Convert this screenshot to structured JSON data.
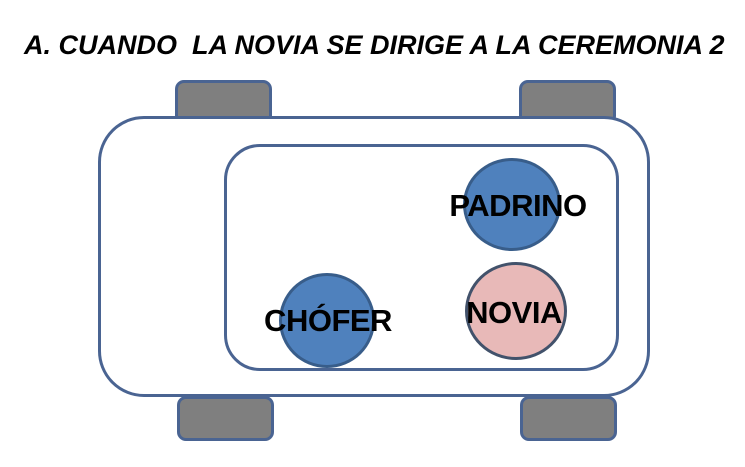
{
  "title": "A. CUANDO  LA NOVIA SE DIRIGE A LA CEREMONIA 2",
  "diagram": {
    "type": "car-seating-top-view",
    "seats": [
      {
        "id": "padrino",
        "label": "PADRINO",
        "position": "back-row-right",
        "fill": "#4f81bd",
        "border": "#385d8a"
      },
      {
        "id": "chofer",
        "label": "CHÓFER",
        "position": "front-row-left",
        "fill": "#4f81bd",
        "border": "#385d8a"
      },
      {
        "id": "novia",
        "label": "NOVIA",
        "position": "front-row-right",
        "fill": "#e8b9b8",
        "border": "#42526b"
      }
    ],
    "colors": {
      "car_outline": "#4a6492",
      "wheel_fill": "#7f7f7f",
      "background": "#ffffff",
      "label_text": "#000000"
    }
  }
}
